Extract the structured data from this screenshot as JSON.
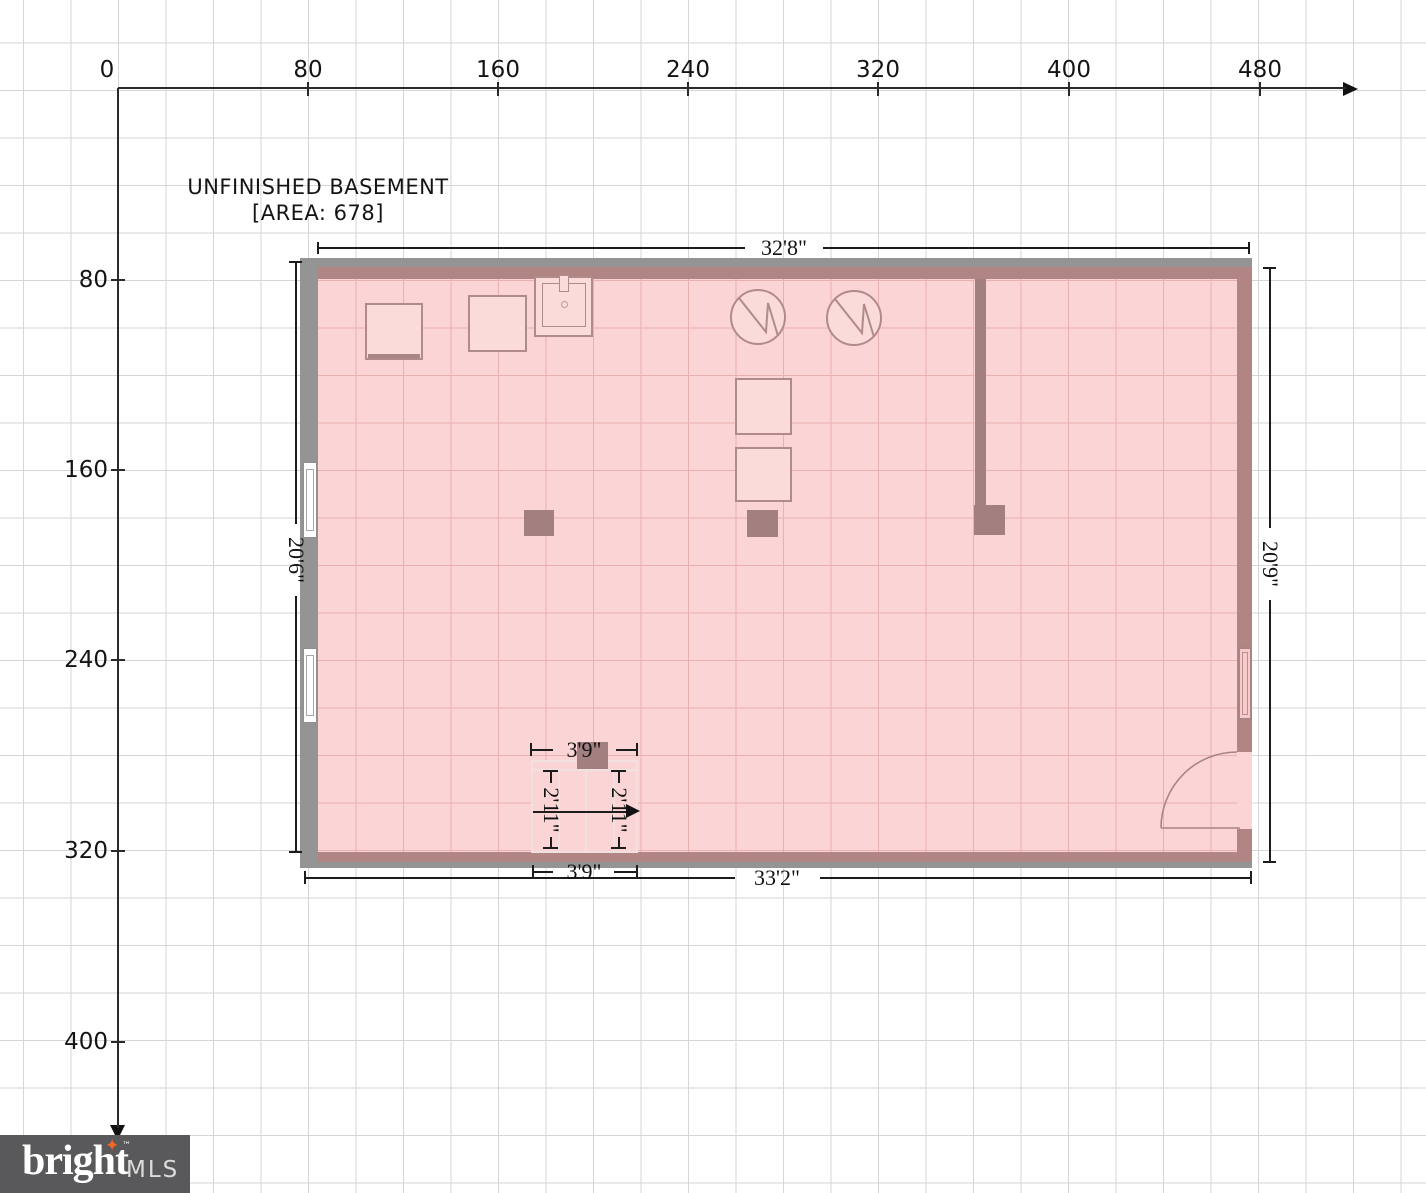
{
  "title": {
    "room_name": "UNFINISHED BASEMENT",
    "area_label": "[AREA: 678]",
    "area_value": 678
  },
  "axes": {
    "x_labels": [
      "0",
      "80",
      "160",
      "240",
      "320",
      "400",
      "480"
    ],
    "y_labels": [
      "80",
      "160",
      "240",
      "320",
      "400"
    ],
    "units_per_grid": 20
  },
  "dimensions": {
    "top_width": "32'8\"",
    "bottom_width": "33'2\"",
    "left_height": "20'6\"",
    "right_height": "20'9\"",
    "stair_width_top": "3'9\"",
    "stair_width_bottom": "3'9\"",
    "stair_run_left": "2'11\"",
    "stair_run_right": "2'11\""
  },
  "fixtures": {
    "water_heaters": 2,
    "sink": 1,
    "appliance_squares": 4,
    "support_posts": 4,
    "windows_left": 2,
    "windows_right": 1,
    "doors": 1,
    "stairs": 1
  },
  "logo": {
    "brand": "bright",
    "star": "✦",
    "tm": "™",
    "suffix": "MLS"
  },
  "colors": {
    "floor_fill": "#fbd5d5",
    "floor_grid": "#eab0b0",
    "wall_gray": "#949494",
    "wall_mauve": "#b28585",
    "interior_wall": "#a28080",
    "page_grid": "#d6d6d6",
    "dimension_ink": "#1c1c1c",
    "logo_bg": "#59595b",
    "logo_star": "#f26722"
  }
}
